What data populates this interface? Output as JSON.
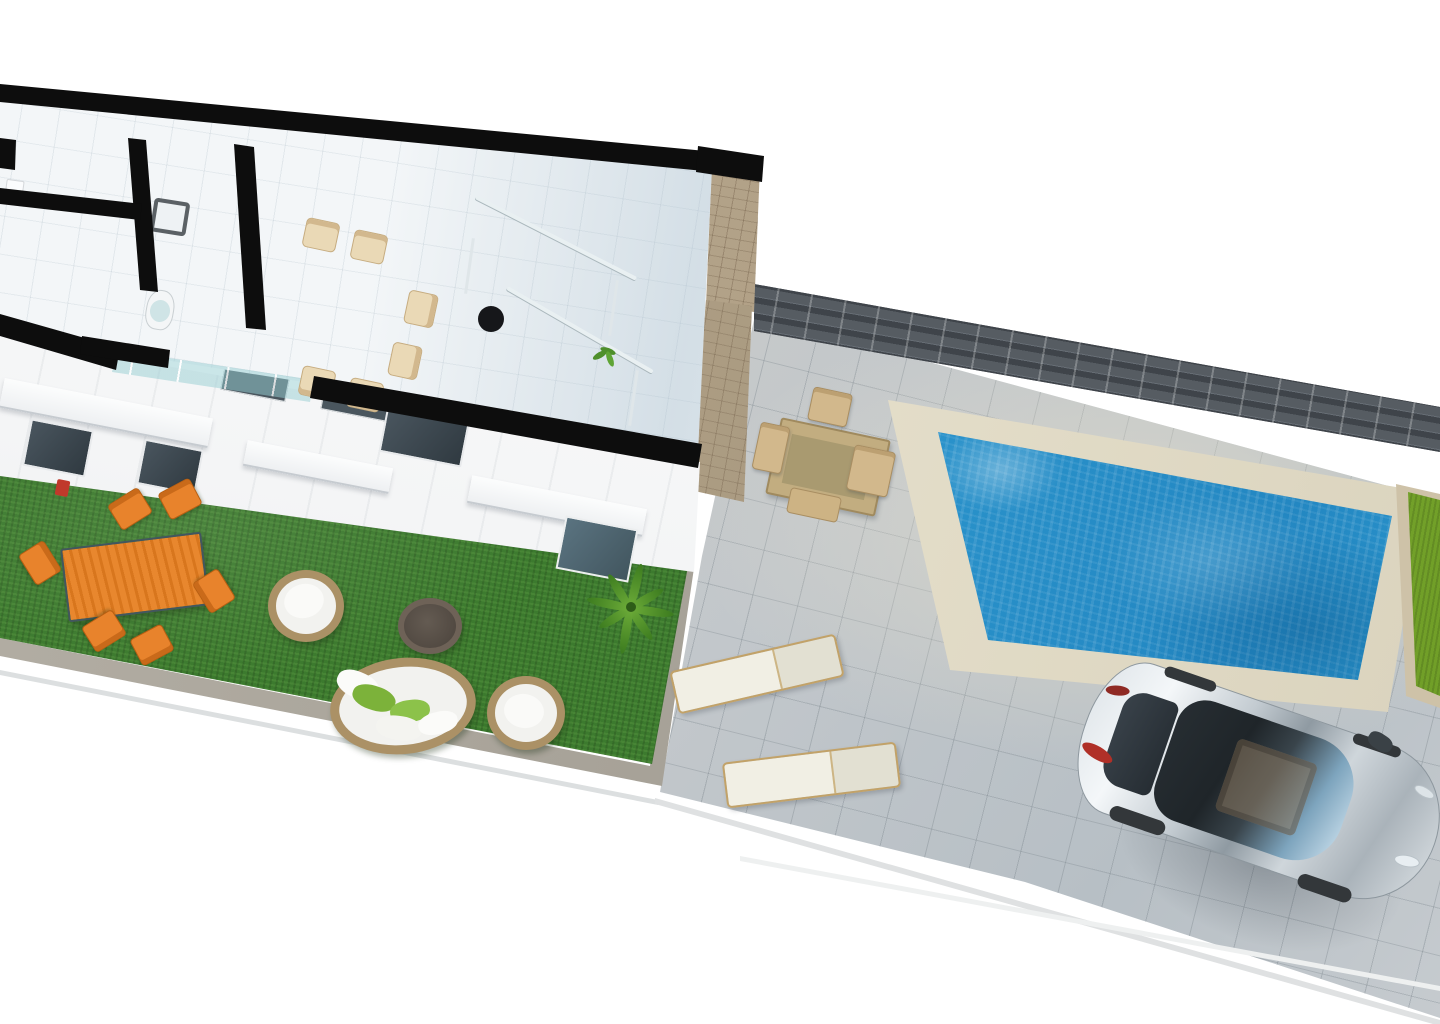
{
  "scene": {
    "description": "Aerial 3D architectural render of a single-storey townhouse cutaway floor plan with private garden, pool terrace, driveway and parked silver car",
    "view": "top-down oblique",
    "background_color": "#ffffff",
    "text_content": "none"
  },
  "palette": {
    "cut_walls": "#0d0d0d",
    "interior_floor": "#f3f6f8",
    "light_wood": "#d8c4a4",
    "stair_wood": "#c79f62",
    "garden_grass": "#3c7a2e",
    "neighbor_grass": "#79a82e",
    "patio_tiles": "#c2c7cb",
    "pool_water": "#2f9fd4",
    "pool_coping": "#e9e4d2",
    "fence": "#4a4f55",
    "stone_wall": "#b3a289",
    "orange_furniture": "#e8832c",
    "wicker_rattan": "#ab9166",
    "car_body": "#c3cbd1"
  },
  "house": {
    "rooms": [
      {
        "name": "bedroom-closet",
        "items": [
          "light-wood-wardrobe",
          "side-counter-with-white-items"
        ]
      },
      {
        "name": "bedroom",
        "items": [
          "double-bed-with-white-duvet",
          "wood-bed-frame"
        ]
      },
      {
        "name": "bathroom",
        "items": [
          "dark-vanity",
          "white-sink",
          "toilet",
          "glass-shower"
        ]
      },
      {
        "name": "dining-room",
        "items": [
          "wood-dining-table",
          "six-wood-chairs",
          "glass-sliding-door"
        ]
      },
      {
        "name": "stair-hall",
        "items": [
          "winder-wood-staircase",
          "glass-railing-with-posts",
          "dark-desk",
          "black-office-chair",
          "wood-sideboard",
          "small-plant"
        ]
      }
    ],
    "wall_style": "thick black cutaway plan walls"
  },
  "facade": {
    "windows_dark": 4,
    "upper_slit_windows": 2,
    "white_awnings": 3,
    "accent": "red-planter"
  },
  "garden": {
    "items": [
      "orange-slat-dining-table",
      "orange-chairs-x6",
      "round-wicker-lounge-chair-x2",
      "round-wicker-daybed",
      "round-dark-ottoman",
      "palm-plant"
    ],
    "pillows_on_daybed": [
      "green",
      "green",
      "white",
      "white",
      "white"
    ]
  },
  "patio": {
    "items": [
      "teak-square-table",
      "teak-chairs-x3",
      "teak-bench",
      "sun-lounger-x2"
    ],
    "surface": "large square pavers"
  },
  "pool": {
    "shape": "rectangular",
    "coping": "cream stone border",
    "water": "mottled azure blue"
  },
  "boundary": {
    "fence": "dark horizontal-slat privacy fence along rear",
    "stone_pier": "beige masonry wall between house and terrace",
    "neighbor_strip": "bright green lawn at far right"
  },
  "vehicle": {
    "type": "hatchback-car",
    "color": "silver",
    "features": [
      "panoramic-glass-roof",
      "tan-interior-visible",
      "side-mirror",
      "red-taillights"
    ],
    "location": "driveway bottom right"
  }
}
